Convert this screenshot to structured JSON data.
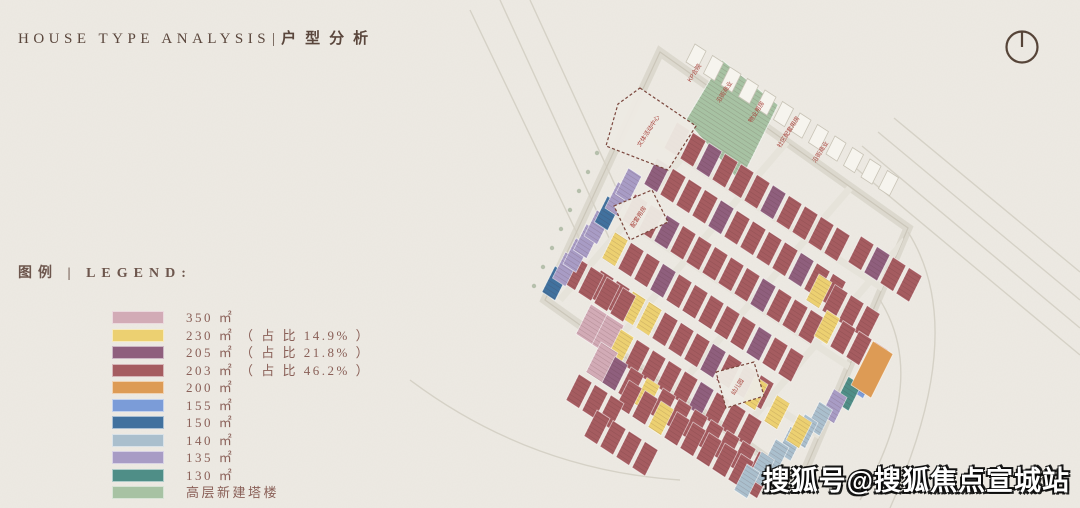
{
  "header": {
    "title_en": "HOUSE TYPE ANALYSIS",
    "divider": "|",
    "title_zh": "户型分析"
  },
  "legend": {
    "heading": "图例 | LEGEND:",
    "items": [
      {
        "id": "350",
        "label": "350 ㎡",
        "color": "#d2abb6"
      },
      {
        "id": "230",
        "label": "230 ㎡ （ 占 比 14.9% ）",
        "color": "#ecd071"
      },
      {
        "id": "205",
        "label": "205 ㎡ （ 占 比 21.8% ）",
        "color": "#8f5f7d"
      },
      {
        "id": "203",
        "label": "203 ㎡ （ 占 比 46.2% ）",
        "color": "#a55c60"
      },
      {
        "id": "200",
        "label": "200 ㎡",
        "color": "#dd9b55"
      },
      {
        "id": "155",
        "label": "155 ㎡",
        "color": "#7b9cd8"
      },
      {
        "id": "150",
        "label": "150 ㎡",
        "color": "#41719e"
      },
      {
        "id": "140",
        "label": "140 ㎡",
        "color": "#aabfcd"
      },
      {
        "id": "135",
        "label": "135 ㎡",
        "color": "#a89cc5"
      },
      {
        "id": "130",
        "label": "130 ㎡",
        "color": "#4f8e87"
      },
      {
        "id": "tower",
        "label": "高层新建塔楼",
        "color": "#a7c2a3"
      }
    ]
  },
  "compass": {
    "name": "north-indicator",
    "color": "#564438"
  },
  "watermark": {
    "text": "搜狐号@搜狐焦点宣城站"
  },
  "plan": {
    "paper": "#edeae3",
    "road_color": "#e6e3da",
    "line_color": "#d5d1c6",
    "dash_color": "#7a463c",
    "label_red": "#a8433c",
    "palette": {
      "m": "#a55c60",
      "p": "#8f5f7d",
      "y": "#ecd071",
      "k": "#d2abb6",
      "o": "#dd9b55",
      "b": "#7b9cd8",
      "d": "#41719e",
      "g": "#aabfcd",
      "l": "#a89cc5",
      "t": "#4f8e87",
      "w": "#f6f4ee"
    },
    "boundary": "660,52 908,228 800,482 545,300",
    "green_tower": "722,60 778,105 740,182 686,120",
    "orange_unit": {
      "x": 851,
      "y": 385
    },
    "rows": [
      {
        "x": 686,
        "y": 62,
        "n": 12,
        "c": "wwwwwwwwwwww",
        "sx": 17.5,
        "sy": 11.5,
        "small": true
      },
      {
        "x": 664,
        "y": 148,
        "n": 11,
        "c": "mmpmmmpmmmm"
      },
      {
        "x": 644,
        "y": 184,
        "n": 12,
        "c": "pmmmpmmmmpmm"
      },
      {
        "x": 622,
        "y": 220,
        "n": 12,
        "c": "mmpmmmmmpmmm"
      },
      {
        "x": 602,
        "y": 258,
        "n": 12,
        "c": "ymmpmmmmmpmm"
      },
      {
        "x": 588,
        "y": 296,
        "n": 11,
        "c": "mmyymmmpmmm"
      },
      {
        "x": 562,
        "y": 282,
        "n": 4,
        "c": "mmmm"
      },
      {
        "x": 576,
        "y": 334,
        "n": 11,
        "c": "kkymmmmpmmm"
      },
      {
        "x": 586,
        "y": 372,
        "n": 11,
        "c": "kpmymmmmmmm"
      },
      {
        "x": 616,
        "y": 406,
        "n": 9,
        "c": "mmymmmmmm"
      },
      {
        "x": 566,
        "y": 400,
        "n": 3,
        "c": "mmm"
      },
      {
        "x": 584,
        "y": 436,
        "n": 4,
        "c": "mmmm"
      },
      {
        "x": 850,
        "y": 390,
        "n": 9,
        "c": "btlgggggg",
        "sx": -14.5,
        "sy": 12.5
      },
      {
        "x": 542,
        "y": 292,
        "n": 8,
        "c": "dlllldll",
        "sx": 10.5,
        "sy": -14
      },
      {
        "x": 742,
        "y": 402,
        "n": 3,
        "c": "yyy",
        "sx": 22,
        "sy": 19
      },
      {
        "x": 848,
        "y": 262,
        "n": 4,
        "c": "mpmm"
      },
      {
        "x": 806,
        "y": 300,
        "n": 4,
        "c": "ymmm"
      },
      {
        "x": 814,
        "y": 336,
        "n": 4,
        "c": "ymmm"
      }
    ],
    "edge_labels": [
      {
        "x": 696,
        "y": 74,
        "t": "KP合院"
      },
      {
        "x": 726,
        "y": 93,
        "t": "沿街商业"
      },
      {
        "x": 758,
        "y": 113,
        "t": "物业用房"
      },
      {
        "x": 790,
        "y": 133,
        "t": "社区配套用房"
      },
      {
        "x": 822,
        "y": 153,
        "t": "沿街商业"
      }
    ],
    "dashed_areas": [
      {
        "pts": "640,88 696,126 668,170 606,146 618,104",
        "label": "文体活动中心",
        "lx": 650,
        "ly": 132
      },
      {
        "pts": "614,206 652,190 668,222 630,240",
        "label": "配套用房",
        "lx": 640,
        "ly": 218
      },
      {
        "pts": "716,372 754,362 764,396 726,408",
        "label": "幼儿园",
        "lx": 739,
        "ly": 388
      }
    ],
    "streets": [
      "M 560 300 L 740 90",
      "M 600 360 L 790 138",
      "M 648 422 L 850 188",
      "M 700 480 L 905 240",
      "M 610 210 L 900 400",
      "M 580 280 L 860 462",
      "M 640 130 L 910 306"
    ],
    "outside_roads": [
      "M 846 160 L 1080 355",
      "M 862 146 L 1080 328",
      "M 878 132 L 1080 300",
      "M 894 118 L 1080 272",
      "M 470 10 L 585 250",
      "M 500 0 L 610 240",
      "M 530 0 L 638 235",
      "M 410 380 Q 530 470 680 480",
      "M 908 232 Q 970 330 890 508",
      "M 880 300 Q 930 380 860 500"
    ],
    "trees": [
      [
        534,
        286
      ],
      [
        543,
        267
      ],
      [
        552,
        248
      ],
      [
        561,
        229
      ],
      [
        570,
        210
      ],
      [
        579,
        191
      ],
      [
        588,
        172
      ],
      [
        597,
        153
      ]
    ]
  }
}
